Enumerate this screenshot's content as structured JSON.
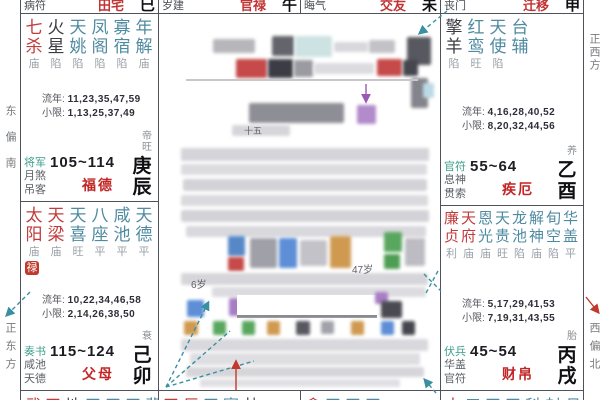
{
  "strip": {
    "items": [
      {
        "god": "病符",
        "palace": "田宅",
        "branch": "巳"
      },
      {
        "god": "岁建",
        "palace": "官禄",
        "branch": "午"
      },
      {
        "god": "晦气",
        "palace": "交友",
        "branch": "未"
      },
      {
        "god": "丧门",
        "palace": "迁移",
        "branch": "申"
      }
    ]
  },
  "labels": {
    "liunian": "流年:",
    "xiaoxian": "小限:"
  },
  "directions": {
    "left_top": "东偏南",
    "left_bottom": "正东方",
    "right_top": "正西方",
    "right_bottom": "西偏北"
  },
  "palaces": [
    {
      "key": "chen",
      "stars": [
        [
          "七杀",
          "major"
        ],
        [
          "火星",
          "malefic"
        ],
        [
          "天姚",
          "minor"
        ],
        [
          "凤阁",
          "minor"
        ],
        [
          "寡宿",
          "minor"
        ],
        [
          "年解",
          "minor"
        ]
      ],
      "brightness": [
        "庙",
        "陷",
        "陷",
        "陷",
        "陷",
        "庙"
      ],
      "liunian": "11,23,35,47,59",
      "xiaoxian": "1,13,25,37,49",
      "stage": "帝旺",
      "gods": [
        "将军",
        "月煞",
        "吊客"
      ],
      "age_range": "105~114",
      "palace_name": "福德",
      "stem_branch": "庚辰",
      "badge": ""
    },
    {
      "key": "mao",
      "stars": [
        [
          "太阳",
          "major"
        ],
        [
          "天梁",
          "major"
        ],
        [
          "天喜",
          "minor"
        ],
        [
          "八座",
          "minor"
        ],
        [
          "咸池",
          "minor"
        ],
        [
          "天德",
          "minor"
        ]
      ],
      "brightness": [
        "庙",
        "庙",
        "旺",
        "平",
        "平",
        "平"
      ],
      "liunian": "10,22,34,46,58",
      "xiaoxian": "2,14,26,38,50",
      "stage": "衰",
      "gods": [
        "奏书",
        "咸池",
        "天德"
      ],
      "age_range": "115~124",
      "palace_name": "父母",
      "stem_branch": "己卯",
      "badge": "禄"
    },
    {
      "key": "you",
      "stars": [
        [
          "擎羊",
          "malefic"
        ],
        [
          "红鸾",
          "minor"
        ],
        [
          "天使",
          "minor"
        ],
        [
          "台辅",
          "minor"
        ]
      ],
      "brightness": [
        "陷",
        "旺",
        "陷",
        ""
      ],
      "liunian": "4,16,28,40,52",
      "xiaoxian": "8,20,32,44,56",
      "stage": "养",
      "gods": [
        "官符",
        "息神",
        "贯索"
      ],
      "age_range": "55~64",
      "palace_name": "疾厄",
      "stem_branch": "乙酉",
      "badge": ""
    },
    {
      "key": "xu",
      "stars": [
        [
          "廉贞",
          "major"
        ],
        [
          "天府",
          "major"
        ],
        [
          "恩光",
          "minor"
        ],
        [
          "天贵",
          "minor"
        ],
        [
          "龙池",
          "minor"
        ],
        [
          "解神",
          "minor"
        ],
        [
          "旬空",
          "minor"
        ],
        [
          "华盖",
          "minor"
        ]
      ],
      "brightness": [
        "利",
        "庙",
        "庙",
        "旺",
        "陷",
        "庙",
        "陷",
        "平"
      ],
      "liunian": "5,17,29,41,53",
      "xiaoxian": "7,19,31,43,55",
      "stage": "胎",
      "gods": [
        "伏兵",
        "华盖",
        "官符"
      ],
      "age_range": "45~54",
      "palace_name": "财帛",
      "stem_branch": "丙戌",
      "badge": ""
    }
  ],
  "bottom_row": [
    {
      "chars": [
        [
          "武",
          "major"
        ],
        [
          "天",
          "major"
        ],
        [
          "地",
          "malefic"
        ],
        [
          "天",
          "minor"
        ],
        [
          "天",
          "minor"
        ],
        [
          "天",
          "minor"
        ],
        [
          "蜚",
          "minor"
        ]
      ]
    },
    {
      "chars": [
        [
          "天",
          "major"
        ],
        [
          "巨",
          "major"
        ],
        [
          "天",
          "minor"
        ],
        [
          "寡",
          "minor"
        ],
        [
          "劫",
          "malefic"
        ]
      ]
    },
    {
      "chars": [
        [
          "贪",
          "major"
        ],
        [
          "天",
          "minor"
        ],
        [
          "天",
          "minor"
        ],
        [
          "天",
          "minor"
        ]
      ]
    },
    {
      "chars": [
        [
          "太",
          "major"
        ],
        [
          "三",
          "minor"
        ],
        [
          "天",
          "minor"
        ],
        [
          "天",
          "minor"
        ],
        [
          "科",
          "minor"
        ],
        [
          "封",
          "minor"
        ],
        [
          "月",
          "minor"
        ]
      ]
    }
  ],
  "center": {
    "fragments": [
      {
        "text": "十五",
        "x": 244,
        "y": 124,
        "size": 9
      },
      {
        "text": "47岁",
        "x": 352,
        "y": 261,
        "size": 10
      },
      {
        "text": "6岁",
        "x": 191,
        "y": 276,
        "size": 10
      }
    ],
    "censor_blocks": [
      {
        "x": 213,
        "y": 39,
        "w": 42,
        "h": 14,
        "c": "#b6b6bb"
      },
      {
        "x": 272,
        "y": 36,
        "w": 22,
        "h": 20,
        "c": "#64646c"
      },
      {
        "x": 295,
        "y": 36,
        "w": 37,
        "h": 21,
        "c": "#cde2e2"
      },
      {
        "x": 334,
        "y": 42,
        "w": 34,
        "h": 10,
        "c": "#d8d8dc"
      },
      {
        "x": 369,
        "y": 40,
        "w": 26,
        "h": 13,
        "c": "#c2c2c7"
      },
      {
        "x": 407,
        "y": 37,
        "w": 24,
        "h": 28,
        "c": "#585860"
      },
      {
        "x": 236,
        "y": 59,
        "w": 31,
        "h": 19,
        "c": "#c64a4a"
      },
      {
        "x": 268,
        "y": 59,
        "w": 25,
        "h": 19,
        "c": "#3c3c44"
      },
      {
        "x": 294,
        "y": 60,
        "w": 19,
        "h": 17,
        "c": "#9a9aa1"
      },
      {
        "x": 314,
        "y": 63,
        "w": 60,
        "h": 11,
        "c": "#dcdce0"
      },
      {
        "x": 377,
        "y": 59,
        "w": 25,
        "h": 17,
        "c": "#c64a4a"
      },
      {
        "x": 403,
        "y": 60,
        "w": 15,
        "h": 16,
        "c": "#46464e"
      },
      {
        "x": 411,
        "y": 78,
        "w": 17,
        "h": 30,
        "c": "#84848c"
      },
      {
        "x": 186,
        "y": 79,
        "w": 232,
        "h": 2,
        "c": "#c6c6cb",
        "sharp": true
      },
      {
        "x": 249,
        "y": 103,
        "w": 95,
        "h": 20,
        "c": "#8e8e96"
      },
      {
        "x": 357,
        "y": 105,
        "w": 19,
        "h": 19,
        "c": "#b28bca"
      },
      {
        "x": 423,
        "y": 83,
        "w": 11,
        "h": 15,
        "c": "#bcd9e6"
      },
      {
        "x": 232,
        "y": 125,
        "w": 58,
        "h": 11,
        "c": "#d6d6da"
      },
      {
        "x": 181,
        "y": 148,
        "w": 248,
        "h": 13,
        "c": "#d4d4d9"
      },
      {
        "x": 181,
        "y": 164,
        "w": 246,
        "h": 11,
        "c": "#dcdce0"
      },
      {
        "x": 183,
        "y": 179,
        "w": 244,
        "h": 12,
        "c": "#d2d2d7"
      },
      {
        "x": 181,
        "y": 195,
        "w": 247,
        "h": 11,
        "c": "#dadade"
      },
      {
        "x": 181,
        "y": 210,
        "w": 248,
        "h": 12,
        "c": "#d2d2d7"
      },
      {
        "x": 186,
        "y": 226,
        "w": 240,
        "h": 11,
        "c": "#d8d8dd"
      },
      {
        "x": 228,
        "y": 236,
        "w": 17,
        "h": 20,
        "c": "#5688c8"
      },
      {
        "x": 228,
        "y": 257,
        "w": 16,
        "h": 14,
        "c": "#c64a4a"
      },
      {
        "x": 250,
        "y": 238,
        "w": 27,
        "h": 30,
        "c": "#a0a0a8"
      },
      {
        "x": 279,
        "y": 238,
        "w": 18,
        "h": 30,
        "c": "#5d8ed6"
      },
      {
        "x": 300,
        "y": 240,
        "w": 27,
        "h": 26,
        "c": "#c2c2c8"
      },
      {
        "x": 330,
        "y": 236,
        "w": 21,
        "h": 32,
        "c": "#cf9a50"
      },
      {
        "x": 384,
        "y": 232,
        "w": 18,
        "h": 20,
        "c": "#59a75e"
      },
      {
        "x": 384,
        "y": 254,
        "w": 16,
        "h": 15,
        "c": "#4d9e53"
      },
      {
        "x": 405,
        "y": 238,
        "w": 20,
        "h": 28,
        "c": "#bcbcc2"
      },
      {
        "x": 181,
        "y": 273,
        "w": 247,
        "h": 12,
        "c": "#d6d6da"
      },
      {
        "x": 212,
        "y": 287,
        "w": 214,
        "h": 10,
        "c": "#dcdce0"
      },
      {
        "x": 187,
        "y": 300,
        "w": 17,
        "h": 17,
        "c": "#5d8ed6"
      },
      {
        "x": 229,
        "y": 298,
        "w": 13,
        "h": 18,
        "c": "#a87dc4"
      },
      {
        "x": 247,
        "y": 300,
        "w": 14,
        "h": 16,
        "c": "#ad7a46"
      },
      {
        "x": 237,
        "y": 295,
        "w": 140,
        "h": 22,
        "c": "#ffffff",
        "sharp": true
      },
      {
        "x": 237,
        "y": 315,
        "w": 140,
        "h": 2,
        "c": "#8a8a92",
        "sharp": true
      },
      {
        "x": 375,
        "y": 292,
        "w": 13,
        "h": 12,
        "c": "#a87dc4"
      },
      {
        "x": 381,
        "y": 301,
        "w": 21,
        "h": 17,
        "c": "#4a4a52"
      },
      {
        "x": 184,
        "y": 321,
        "w": 14,
        "h": 14,
        "c": "#cf9a50"
      },
      {
        "x": 213,
        "y": 321,
        "w": 13,
        "h": 14,
        "c": "#59a75e"
      },
      {
        "x": 242,
        "y": 321,
        "w": 13,
        "h": 14,
        "c": "#59a75e"
      },
      {
        "x": 267,
        "y": 321,
        "w": 13,
        "h": 14,
        "c": "#cf9a50"
      },
      {
        "x": 296,
        "y": 321,
        "w": 14,
        "h": 14,
        "c": "#585860"
      },
      {
        "x": 321,
        "y": 321,
        "w": 13,
        "h": 13,
        "c": "#a2a2aa"
      },
      {
        "x": 351,
        "y": 321,
        "w": 13,
        "h": 14,
        "c": "#cf9a50"
      },
      {
        "x": 381,
        "y": 321,
        "w": 13,
        "h": 14,
        "c": "#5d8ed6"
      },
      {
        "x": 402,
        "y": 321,
        "w": 13,
        "h": 14,
        "c": "#46464e"
      },
      {
        "x": 181,
        "y": 339,
        "w": 247,
        "h": 12,
        "c": "#d8d8dd"
      },
      {
        "x": 190,
        "y": 353,
        "w": 230,
        "h": 12,
        "c": "#dedee2"
      },
      {
        "x": 186,
        "y": 367,
        "w": 238,
        "h": 10,
        "c": "#d6d6da"
      },
      {
        "x": 200,
        "y": 379,
        "w": 200,
        "h": 8,
        "c": "#e0e0e4"
      }
    ],
    "arrows": [
      {
        "color": "teal",
        "dashed": true,
        "x1": 30,
        "y1": 292,
        "x2": 7,
        "y2": 315
      },
      {
        "color": "teal",
        "dashed": true,
        "x1": 447,
        "y1": 11,
        "x2": 420,
        "y2": 33
      },
      {
        "color": "teal",
        "dashed": true,
        "x1": 438,
        "y1": 271,
        "x2": 426,
        "y2": 293,
        "nohead": true
      },
      {
        "color": "teal",
        "dashed": true,
        "x1": 424,
        "y1": 274,
        "x2": 441,
        "y2": 291,
        "nohead": true
      },
      {
        "color": "teal",
        "dashed": true,
        "x1": 166,
        "y1": 387,
        "x2": 208,
        "y2": 303
      },
      {
        "color": "teal",
        "dashed": true,
        "x1": 166,
        "y1": 387,
        "x2": 230,
        "y2": 331,
        "nohead": true
      },
      {
        "color": "teal",
        "dashed": true,
        "x1": 166,
        "y1": 387,
        "x2": 254,
        "y2": 361,
        "nohead": true
      },
      {
        "color": "teal",
        "dashed": true,
        "x1": 436,
        "y1": 393,
        "x2": 425,
        "y2": 380
      },
      {
        "color": "red",
        "dashed": false,
        "x1": 586,
        "y1": 297,
        "x2": 598,
        "y2": 312
      },
      {
        "color": "red",
        "dashed": false,
        "x1": 236,
        "y1": 391,
        "x2": 236,
        "y2": 362
      },
      {
        "color": "purple",
        "dashed": false,
        "x1": 366,
        "y1": 84,
        "x2": 366,
        "y2": 101
      }
    ]
  }
}
